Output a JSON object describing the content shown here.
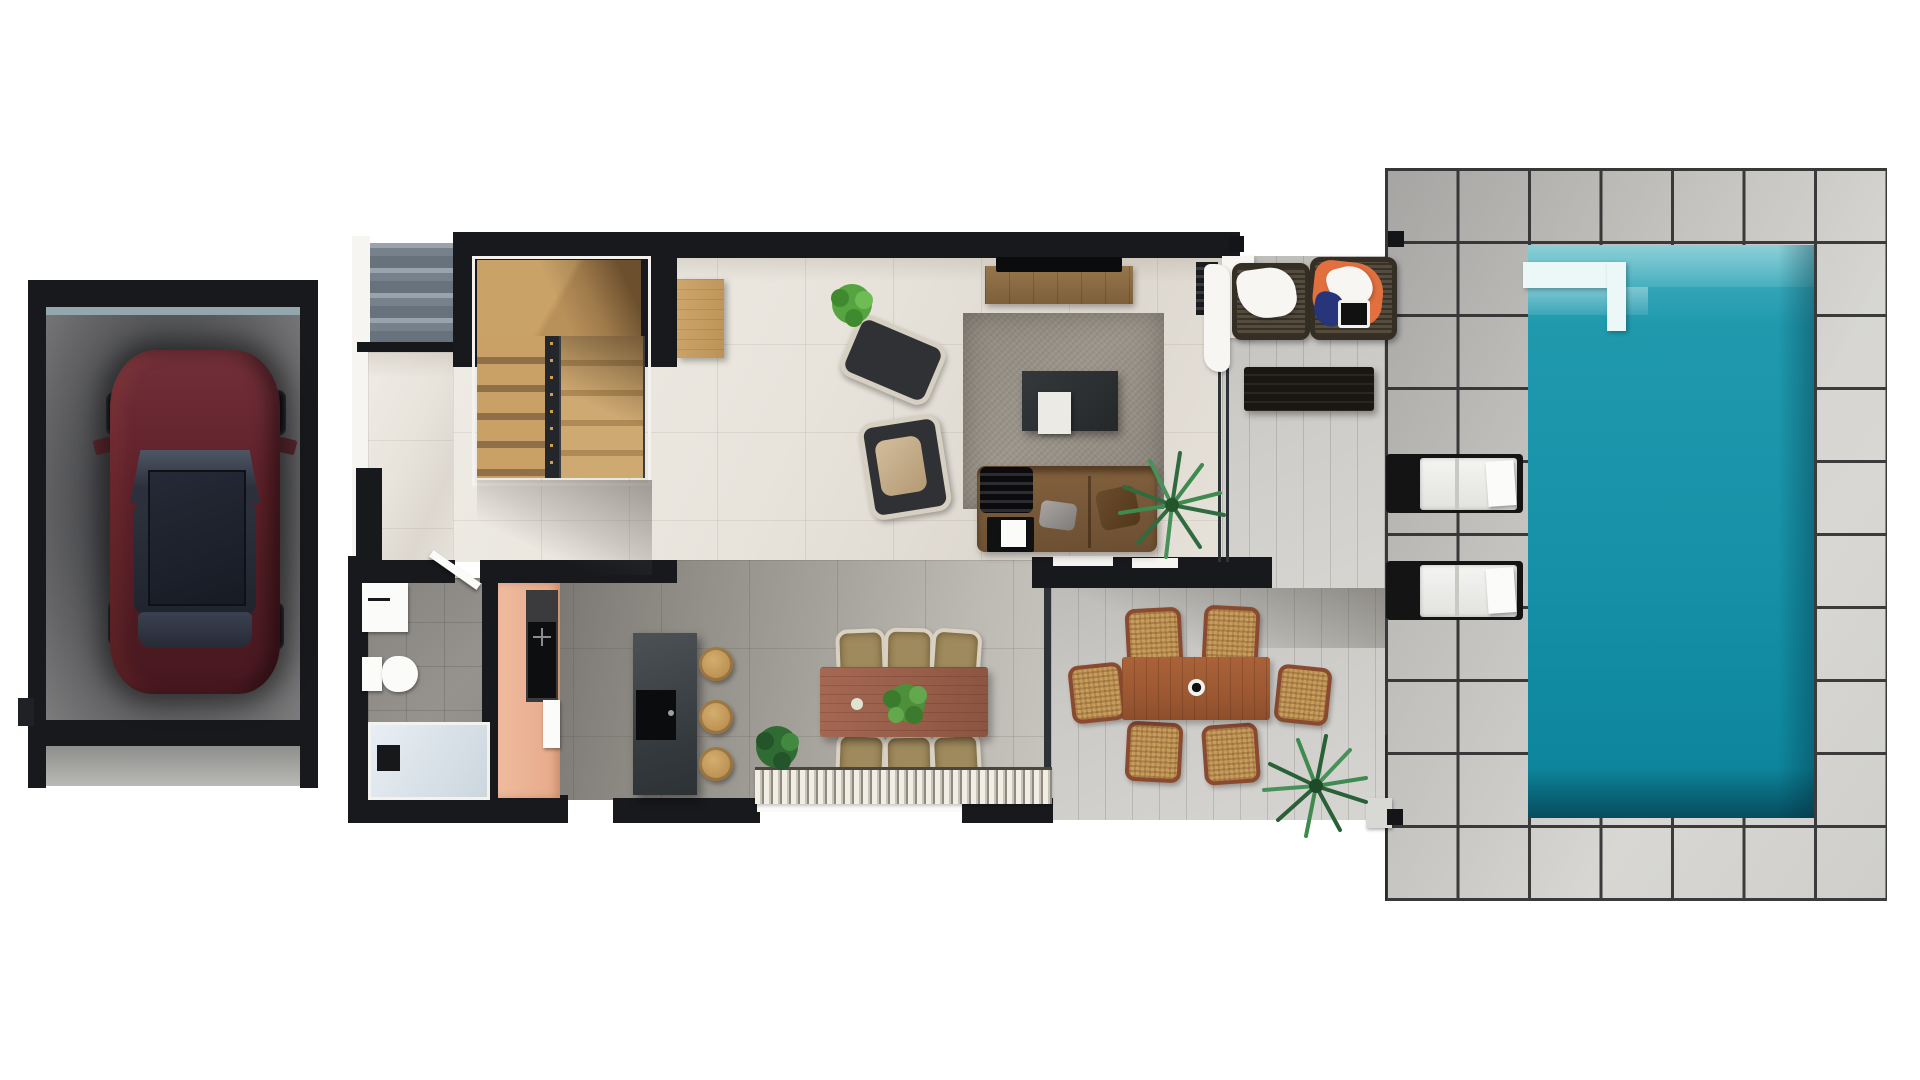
{
  "scene": {
    "kind": "architectural-floor-plan-render-top-view",
    "areas": [
      "garage",
      "entry-steps",
      "staircase",
      "bathroom",
      "kitchen",
      "dining-area",
      "living-room",
      "covered-terrace-lounge",
      "outdoor-dining-terrace",
      "pool-deck",
      "swimming-pool"
    ],
    "counts": {
      "dining_chairs_indoor": 6,
      "dining_chairs_outdoor": 6,
      "bar_stools": 3,
      "sun_loungers": 2,
      "wicker_lounge_chairs": 2,
      "cars": 1,
      "palms": 2
    }
  },
  "palette": {
    "background": "#ffffff",
    "wall_dark": "#17191d",
    "garage_floor": "#47484b",
    "car_body": "#5e2129",
    "car_glass": "#262b35",
    "entry_step": "#76818c",
    "stair_wood": "#c9a167",
    "floor_interior": "#e8e4dc",
    "floor_kitchen_zone": "#a3a099",
    "bathroom_floor": "#96938f",
    "shower_tray": "#dde5ec",
    "cabinet_peach": "#edb296",
    "island_dark": "#42474b",
    "cooktop_black": "#0d0e10",
    "stool_tan": "#b98f52",
    "dining_table_wood": "#995f4a",
    "chair_beige": "#9f8a5d",
    "chair_frame_cream": "#d9d2c2",
    "rug_living": "#948e83",
    "sofa_brown": "#765738",
    "tv_black": "#0b0c0e",
    "console_wood": "#96764c",
    "sideboard_oak": "#c9a268",
    "plant_green": "#4e8f3c",
    "palm_green": "#2f6b3f",
    "terrace_plank": "#cccbc7",
    "deck_tile": "#d4d3cf",
    "deck_grout": "#3b3b3b",
    "pool_water": "#1691a7",
    "pool_shelf_light": "#5fc3cf",
    "pool_step_white": "#ecf7f7",
    "lounger_white": "#f4f4f2",
    "outdoor_table_wood": "#9c5832",
    "wicker_tan": "#c79d5c",
    "wicker_frame_rust": "#8a4a30",
    "towel_orange": "#e2703f",
    "towel_blue": "#27357a",
    "towel_white": "#f5f4f1",
    "mat_stripe_light": "#f1eee6",
    "mat_stripe_dark": "#8f8a7e"
  },
  "objects": [
    "burgundy-car",
    "garage-door",
    "entry-steps",
    "wood-staircase",
    "vanity-sink",
    "toilet",
    "walk-in-shower",
    "bathroom-door",
    "kitchen-cabinets",
    "cooktop",
    "fridge",
    "kitchen-island",
    "bar-stools",
    "dining-table",
    "dining-chairs",
    "table-plant",
    "fringe-rug",
    "area-rug",
    "tv",
    "tv-console",
    "coffee-table",
    "white-tray",
    "sofa",
    "black-throw",
    "side-table",
    "armchairs",
    "oak-sideboard",
    "potted-plants",
    "palm-plants",
    "glass-partition",
    "outdoor-dining-table",
    "wicker-dining-chairs",
    "wicker-lounge-chairs",
    "beach-towels",
    "slatted-coffee-table",
    "pergola-posts",
    "sun-loungers",
    "pool-entry-step",
    "swimming-pool"
  ]
}
